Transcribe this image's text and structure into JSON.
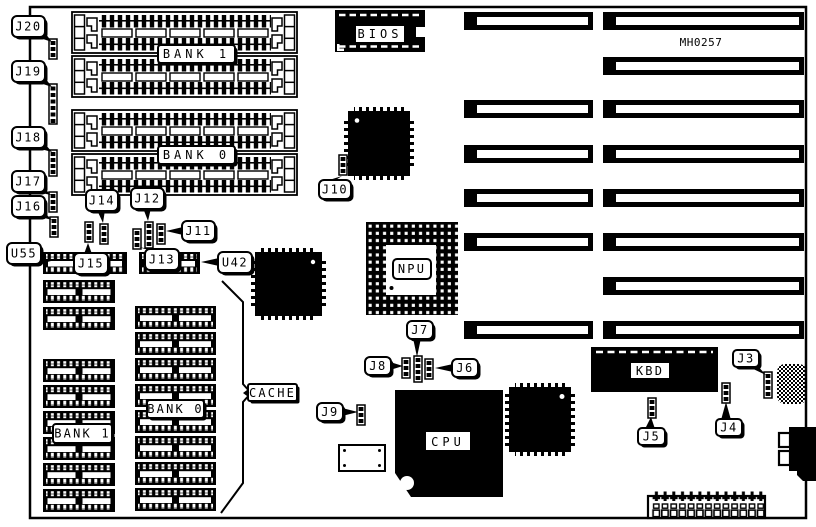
{
  "board": {
    "part_number": "MH0257",
    "ink": "#000000",
    "paper": "#ffffff"
  },
  "chips": {
    "bios": "BIOS",
    "npu": "NPU",
    "cpu": "CPU",
    "kbd": "KBD"
  },
  "memory": {
    "simm_bank_1": "BANK 1",
    "simm_bank_0": "BANK 0",
    "cache": "CACHE",
    "cache_bank_1": "BANK 1",
    "cache_bank_0": "BANK 0"
  },
  "callouts": {
    "j3": "J3",
    "j4": "J4",
    "j5": "J5",
    "j6": "J6",
    "j7": "J7",
    "j8": "J8",
    "j9": "J9",
    "j10": "J10",
    "j11": "J11",
    "j12": "J12",
    "j13": "J13",
    "j14": "J14",
    "j15": "J15",
    "j16": "J16",
    "j17": "J17",
    "j18": "J18",
    "j19": "J19",
    "j20": "J20",
    "u42": "U42",
    "u55": "U55"
  }
}
